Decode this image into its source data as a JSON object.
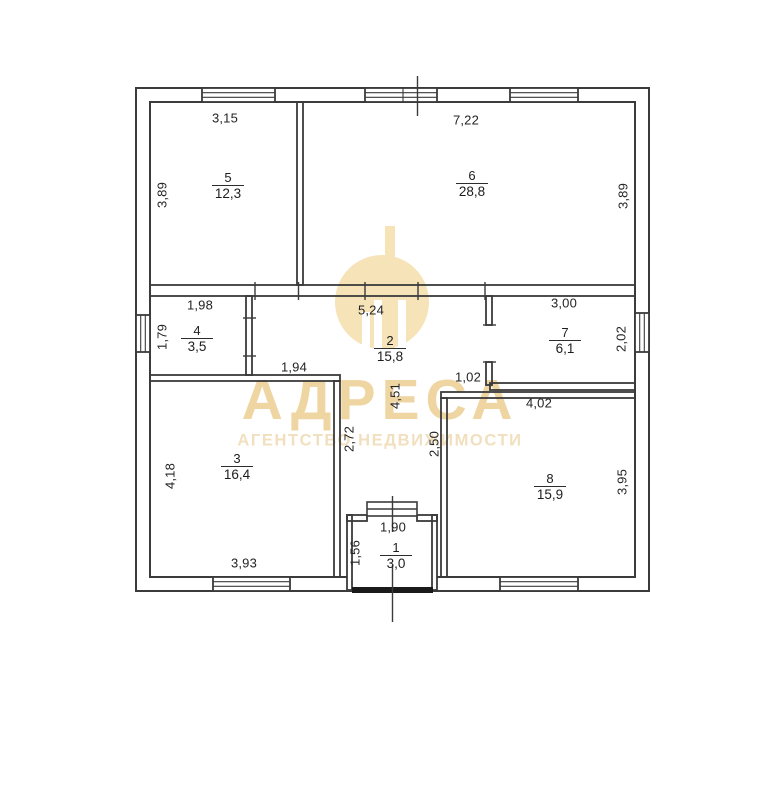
{
  "watermark": {
    "brand": "АДРЕСА",
    "subtitle": "АГЕНТСТВО НЕДВИЖИМОСТИ",
    "gold_color": "#eed5a1",
    "logo_color": "#f6e3b8"
  },
  "plan": {
    "line_color": "#3b3b3b",
    "door_sill_color": "#1a1a1a"
  },
  "rooms": [
    {
      "number": "1",
      "area": "3,0"
    },
    {
      "number": "2",
      "area": "15,8"
    },
    {
      "number": "3",
      "area": "16,4"
    },
    {
      "number": "4",
      "area": "3,5"
    },
    {
      "number": "5",
      "area": "12,3"
    },
    {
      "number": "6",
      "area": "28,8"
    },
    {
      "number": "7",
      "area": "6,1"
    },
    {
      "number": "8",
      "area": "15,9"
    }
  ],
  "dims": {
    "room5_width": "3,15",
    "room6_width": "7,22",
    "room5_height": "3,89",
    "room6_height": "3,89",
    "room4_width": "1,98",
    "hall_width": "5,24",
    "room7_width": "3,00",
    "room4_height": "1,79",
    "room7_height": "2,02",
    "room3_top": "1,94",
    "passage_width": "1,02",
    "room8_width": "4,02",
    "hall_height": "4,51",
    "corridor_left": "2,72",
    "corridor_right": "2,50",
    "room3_height": "4,18",
    "room8_height": "3,95",
    "room3_width": "3,93",
    "room1_width": "1,90",
    "room1_height": "1,56"
  }
}
